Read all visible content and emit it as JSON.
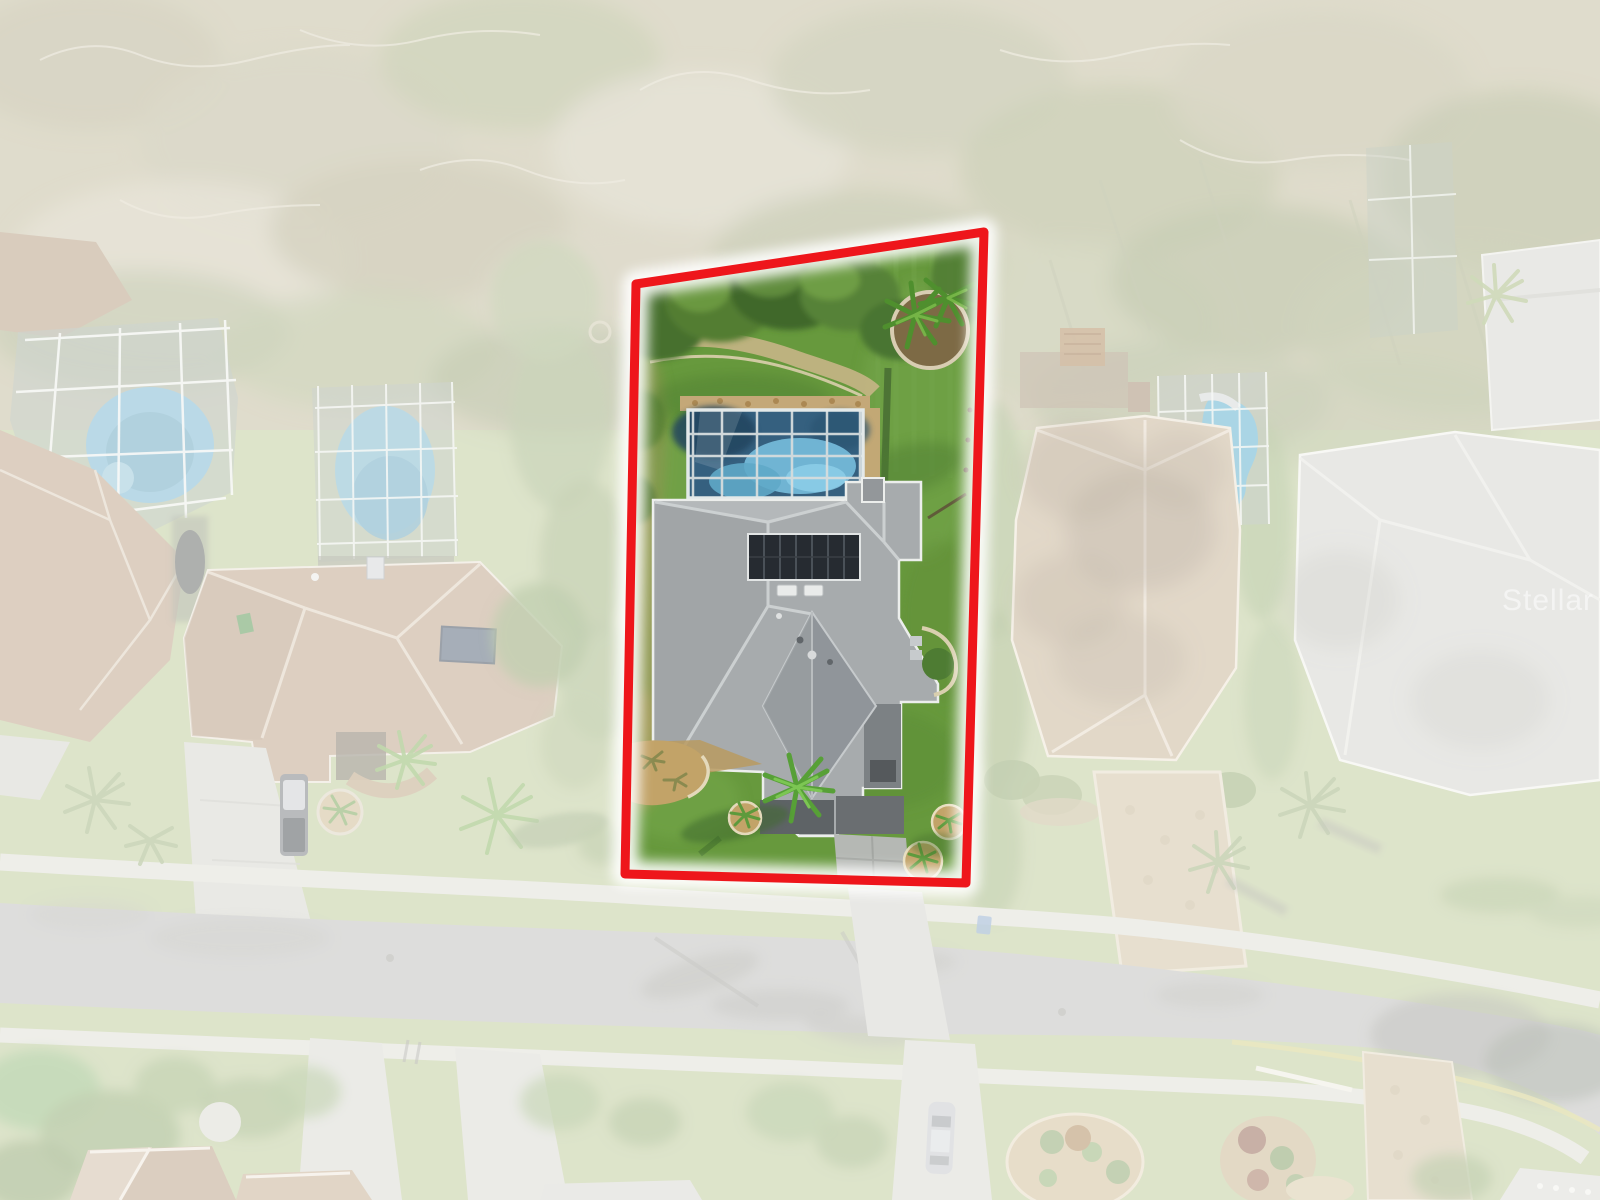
{
  "watermark": {
    "text": "Stellar MLS",
    "color": "#ffffff"
  },
  "highlight": {
    "border_color": "#ee161b",
    "glow_color": "#ffffff"
  },
  "colors": {
    "veil": "#ffffff",
    "faded_lawn": "#b8c691",
    "woodland": "#bdb694",
    "road": "#b9b9b6",
    "sidewalk": "#dcdcd2",
    "lot_lawn": "#67993d",
    "backyard_tree_dark": "#40682c",
    "pool_water": "#35607f",
    "pool_water_light": "#74b8d8",
    "pool_cage_frame": "#d5dcdd",
    "pool_deck": "#c4a878",
    "roof_shingle": "#a7abad",
    "roof_front_gable": "#90959a",
    "solar_panel": "#262b31",
    "skylight": "#e9ebea",
    "driveway_dark": "#6a6e71",
    "driveway_concrete": "#b5b8b4",
    "walkway_dark": "#5e6366",
    "mulch": "#c2a368",
    "mulch_curb": "#e4d9bb",
    "palm_green": "#57a037",
    "neighbor_roof_brown": "#b89b7d",
    "neighbor_roof_tan": "#c2ad8d",
    "neighbor_roof_gray": "#cfcfc9",
    "neighbor_pool": "#6fb0cc",
    "paver_driveway": "#cdbd9c",
    "car_silver": "#c0c3c7",
    "truck_dark": "#6e7275",
    "trash_bin_blue": "#7d9ec7",
    "trash_bin_green": "#4f8f46",
    "curb_yellow": "#d2cc7e"
  }
}
